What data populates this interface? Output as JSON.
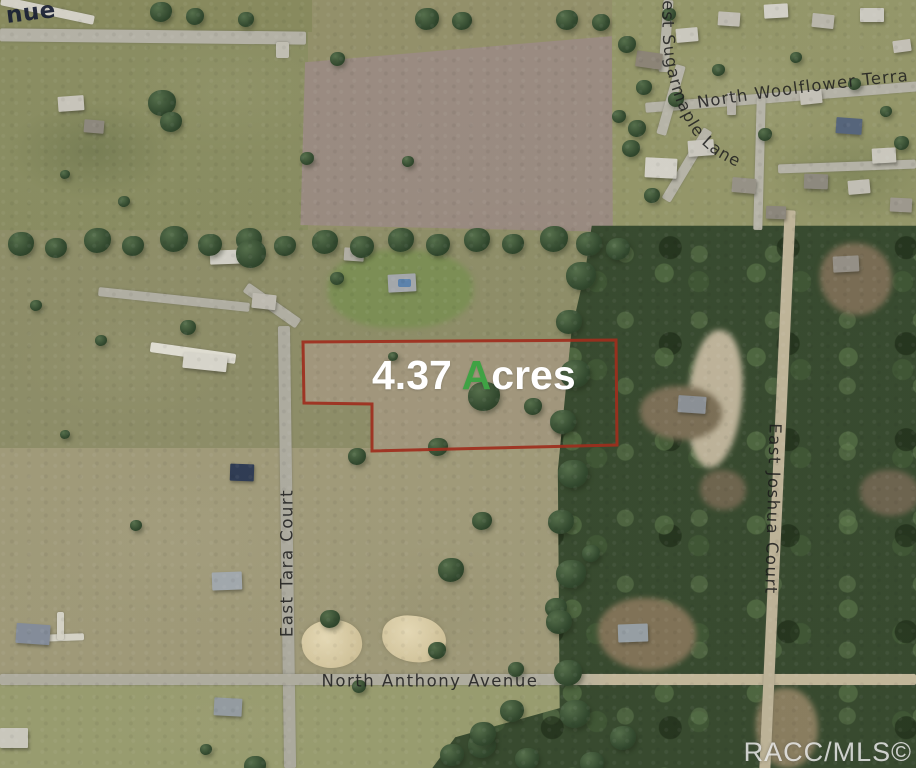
{
  "map": {
    "watermark": "RACC/MLS©",
    "parcel": {
      "acreage_prefix": "4.37 ",
      "acreage_highlight": "A",
      "acreage_suffix": "cres",
      "outline_color": "#9e2e1d",
      "label_color": "#ffffff",
      "highlight_color": "#3fa244"
    },
    "street_labels": [
      {
        "id": "partial-avenue",
        "text": "nue"
      },
      {
        "id": "sugarmaple",
        "text": "est Sugarmaple Lane"
      },
      {
        "id": "woolflower",
        "text": "North Woolflower Terra"
      },
      {
        "id": "tara",
        "text": "East Tara Court"
      },
      {
        "id": "anthony",
        "text": "North Anthony Avenue"
      },
      {
        "id": "joshua",
        "text": "East Joshua Court"
      }
    ]
  }
}
